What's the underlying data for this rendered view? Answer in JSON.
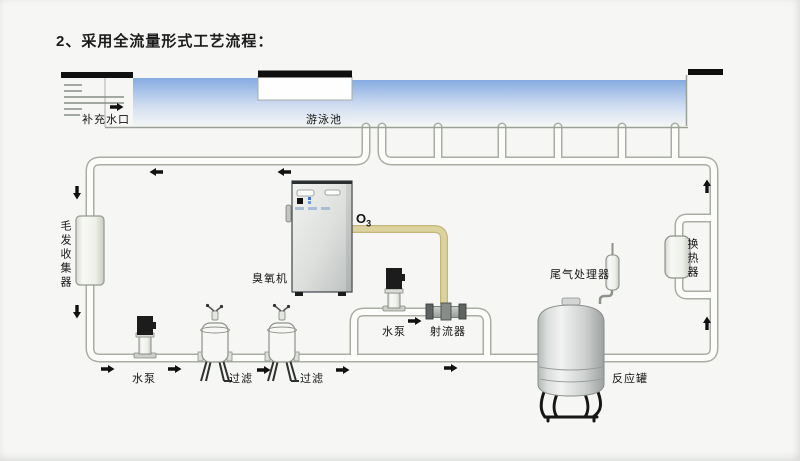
{
  "title": "2、采用全流量形式工艺流程：",
  "diagram": {
    "pool": {
      "makeup_inlet_label": "补充水口",
      "swimming_pool_label": "游泳池"
    },
    "labels": {
      "hair_collector": "毛发收集器",
      "ozone_generator": "臭氧机",
      "o3_symbol": "O",
      "o3_sub": "3",
      "pump_main": "水泵",
      "filter_1": "过滤",
      "filter_2": "过滤",
      "pump_booster": "水泵",
      "ejector": "射流器",
      "tail_gas_processor": "尾气处理器",
      "reaction_tank": "反应罐",
      "heat_exchanger": "换热器"
    },
    "flow_arrows": [
      {
        "at": "makeup-inlet",
        "direction": "right"
      },
      {
        "at": "top-return-line-1",
        "direction": "left"
      },
      {
        "at": "top-return-line-2",
        "direction": "left"
      },
      {
        "at": "left-pipe-upper",
        "direction": "down"
      },
      {
        "at": "left-pipe-lower",
        "direction": "down"
      },
      {
        "at": "bottom-line-start",
        "direction": "right"
      },
      {
        "at": "after-main-pump",
        "direction": "right"
      },
      {
        "at": "after-filter-1",
        "direction": "right"
      },
      {
        "at": "after-filter-2",
        "direction": "right"
      },
      {
        "at": "bridge-pump-to-ejector",
        "direction": "right"
      },
      {
        "at": "bottom-line-under-bridge",
        "direction": "right"
      },
      {
        "at": "right-pipe-upper",
        "direction": "up"
      },
      {
        "at": "right-pipe-lower",
        "direction": "up"
      }
    ],
    "colors": {
      "water_top": "#85abe0",
      "pipe_fill": "#fcfdfa",
      "pipe_outline": "#a9aea4",
      "ozone_pipe": "#dcd29e",
      "deck_bars": "#0f0f0f",
      "background": "#f6f7f5"
    }
  }
}
